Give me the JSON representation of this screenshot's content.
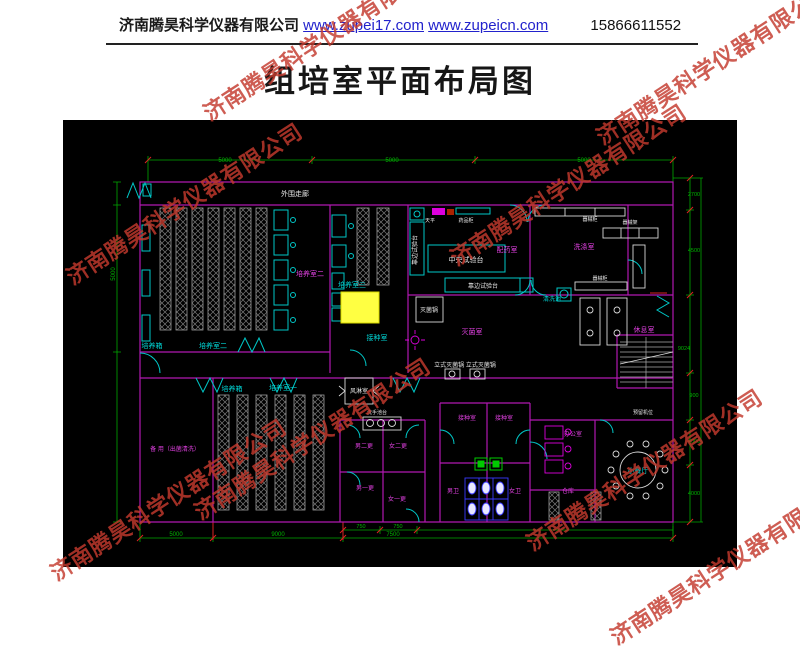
{
  "header": {
    "company": "济南腾昊科学仪器有限公司",
    "url1": "www.zupei17.com",
    "url2": "www.zupeicn.com",
    "phone": "15866611552"
  },
  "title": "组培室平面布局图",
  "watermark_text": "济南腾昊科学仪器有限公司",
  "drawing": {
    "background": "#000000",
    "colors": {
      "wall": "#b018b0",
      "door": "#00c8c8",
      "dimension": "#00b400",
      "rack": "#9a9a9a",
      "white_text": "#e8e8e8",
      "magenta_text": "#e040e0",
      "cyan_text": "#00d8d8",
      "highlight": "#ffff42",
      "tick": "#dd2222",
      "fixture_blue": "#3a3aff",
      "fixture_green": "#00cc00"
    },
    "labels": [
      {
        "t": "培养箱",
        "x": 89,
        "y": 228,
        "c": "cyan",
        "s": 7
      },
      {
        "t": "培养室二",
        "x": 150,
        "y": 228,
        "c": "cyan",
        "s": 7
      },
      {
        "t": "培养箱",
        "x": 169,
        "y": 271,
        "c": "cyan",
        "s": 7
      },
      {
        "t": "培养室一",
        "x": 220,
        "y": 270,
        "c": "cyan",
        "s": 7
      },
      {
        "t": "培养室三",
        "x": 289,
        "y": 167,
        "c": "cyan",
        "s": 7
      },
      {
        "t": "接种室",
        "x": 314,
        "y": 220,
        "c": "cyan",
        "s": 7
      },
      {
        "t": "清洗池",
        "x": 489,
        "y": 181,
        "c": "cyan",
        "s": 6
      },
      {
        "t": "小餐厅",
        "x": 575,
        "y": 353,
        "c": "cyan",
        "s": 7
      },
      {
        "t": "外围走廊",
        "x": 232,
        "y": 76,
        "c": "white",
        "s": 7
      },
      {
        "t": "中央试验台",
        "x": 403,
        "y": 142,
        "c": "white",
        "s": 7
      },
      {
        "t": "靠边试验台",
        "x": 354,
        "y": 130,
        "c": "white",
        "s": 6,
        "r": -90
      },
      {
        "t": "靠边试验台",
        "x": 420,
        "y": 168,
        "c": "white",
        "s": 6
      },
      {
        "t": "天平",
        "x": 367,
        "y": 102,
        "c": "white",
        "s": 5
      },
      {
        "t": "药品柜",
        "x": 403,
        "y": 102,
        "c": "white",
        "s": 5
      },
      {
        "t": "灭菌锅",
        "x": 366,
        "y": 192,
        "c": "white",
        "s": 6
      },
      {
        "t": "立式灭菌锅 立式灭菌锅",
        "x": 402,
        "y": 247,
        "c": "white",
        "s": 6
      },
      {
        "t": "风淋室",
        "x": 296,
        "y": 273,
        "c": "white",
        "s": 6
      },
      {
        "t": "洗手池台",
        "x": 314,
        "y": 294,
        "c": "white",
        "s": 5
      },
      {
        "t": "器械柜",
        "x": 527,
        "y": 101,
        "c": "white",
        "s": 5
      },
      {
        "t": "器械柜",
        "x": 537,
        "y": 160,
        "c": "white",
        "s": 5
      },
      {
        "t": "器械架",
        "x": 567,
        "y": 104,
        "c": "white",
        "s": 5
      },
      {
        "t": "预留机位",
        "x": 580,
        "y": 294,
        "c": "white",
        "s": 5
      },
      {
        "t": "培养室二",
        "x": 247,
        "y": 156,
        "c": "magenta",
        "s": 7
      },
      {
        "t": "配药室",
        "x": 444,
        "y": 132,
        "c": "magenta",
        "s": 7
      },
      {
        "t": "洗涤室",
        "x": 521,
        "y": 129,
        "c": "magenta",
        "s": 7
      },
      {
        "t": "灭菌室",
        "x": 409,
        "y": 214,
        "c": "magenta",
        "s": 7
      },
      {
        "t": "休息室",
        "x": 581,
        "y": 212,
        "c": "magenta",
        "s": 7
      },
      {
        "t": "备 用（出菌清洗）",
        "x": 112,
        "y": 331,
        "c": "magenta",
        "s": 6
      },
      {
        "t": "接种室",
        "x": 404,
        "y": 300,
        "c": "magenta",
        "s": 6
      },
      {
        "t": "接种室",
        "x": 441,
        "y": 300,
        "c": "magenta",
        "s": 6
      },
      {
        "t": "男二更",
        "x": 301,
        "y": 328,
        "c": "magenta",
        "s": 6
      },
      {
        "t": "女二更",
        "x": 335,
        "y": 328,
        "c": "magenta",
        "s": 6
      },
      {
        "t": "男一更",
        "x": 302,
        "y": 370,
        "c": "magenta",
        "s": 6
      },
      {
        "t": "女一更",
        "x": 334,
        "y": 381,
        "c": "magenta",
        "s": 6
      },
      {
        "t": "男卫",
        "x": 390,
        "y": 373,
        "c": "magenta",
        "s": 6
      },
      {
        "t": "女卫",
        "x": 452,
        "y": 373,
        "c": "magenta",
        "s": 6
      },
      {
        "t": "办公室",
        "x": 510,
        "y": 316,
        "c": "magenta",
        "s": 6
      },
      {
        "t": "仓库",
        "x": 505,
        "y": 373,
        "c": "magenta",
        "s": 6
      },
      {
        "t": "5000",
        "x": 162,
        "y": 42,
        "c": "green",
        "s": 6
      },
      {
        "t": "5000",
        "x": 329,
        "y": 42,
        "c": "green",
        "s": 6
      },
      {
        "t": "5000",
        "x": 521,
        "y": 42,
        "c": "green",
        "s": 6
      },
      {
        "t": "2700",
        "x": 631,
        "y": 76,
        "c": "green",
        "s": 5.5
      },
      {
        "t": "4500",
        "x": 631,
        "y": 132,
        "c": "green",
        "s": 5.5
      },
      {
        "t": "9024",
        "x": 621,
        "y": 230,
        "c": "green",
        "s": 5.5
      },
      {
        "t": "900",
        "x": 631,
        "y": 277,
        "c": "green",
        "s": 5.5
      },
      {
        "t": "4000",
        "x": 631,
        "y": 323,
        "c": "green",
        "s": 5.5
      },
      {
        "t": "4000",
        "x": 631,
        "y": 375,
        "c": "green",
        "s": 5.5
      },
      {
        "t": "5000",
        "x": 52,
        "y": 154,
        "c": "green",
        "s": 6,
        "r": -90
      },
      {
        "t": "750",
        "x": 298,
        "y": 408,
        "c": "green",
        "s": 5.5
      },
      {
        "t": "750",
        "x": 335,
        "y": 408,
        "c": "green",
        "s": 5.5
      },
      {
        "t": "5000",
        "x": 113,
        "y": 416,
        "c": "green",
        "s": 6
      },
      {
        "t": "9000",
        "x": 215,
        "y": 416,
        "c": "green",
        "s": 6
      },
      {
        "t": "7500",
        "x": 330,
        "y": 416,
        "c": "green",
        "s": 6
      }
    ]
  }
}
